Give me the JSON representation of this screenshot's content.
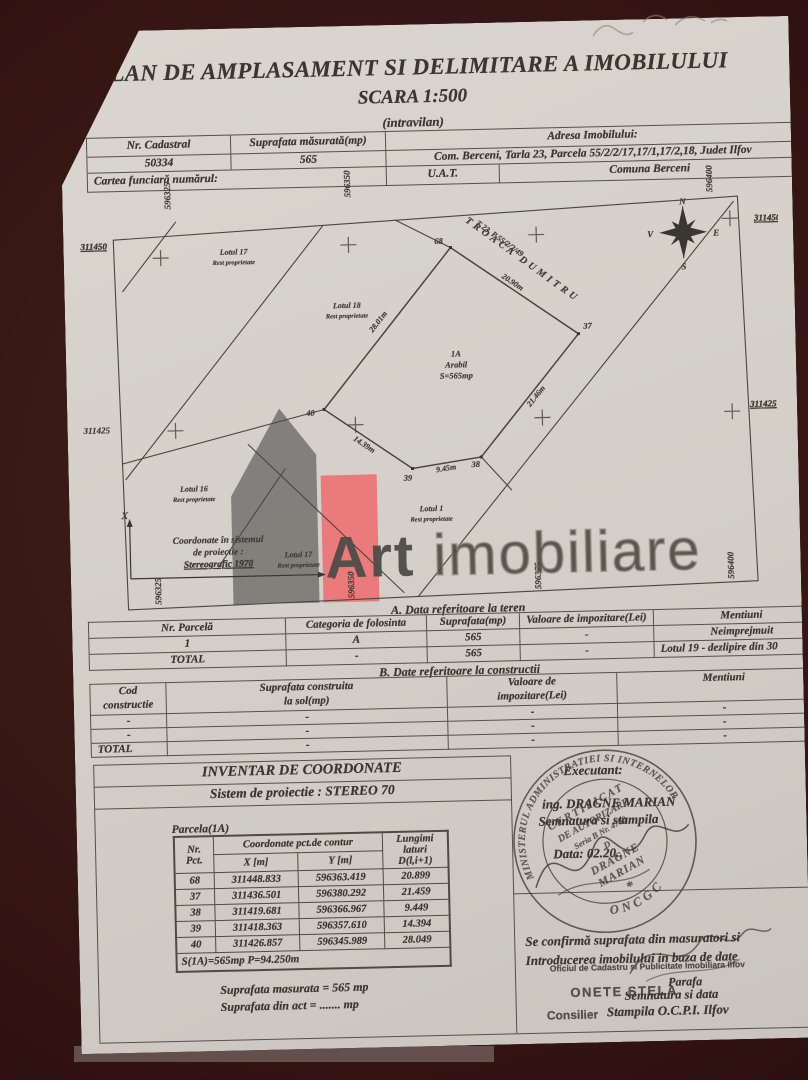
{
  "title": {
    "line1": "PLAN DE AMPLASAMENT SI DELIMITARE A IMOBILULUI",
    "line2": "SCARA 1:500",
    "line3": "(intravilan)"
  },
  "header_table": {
    "col1_label": "Nr. Cadastral",
    "col1_value": "50334",
    "col2_label": "Suprafata măsurată(mp)",
    "col2_value": "565",
    "col3_label": "Adresa Imobilului:",
    "col3_value": "Com. Berceni, Tarla 23, Parcela 55/2/2/17,17/1,17/2,18, Judet Ilfov",
    "row3_label": "Cartea funciară numărul:",
    "uat_label": "U.A.T.",
    "uat_value": "Comuna Berceni"
  },
  "map": {
    "grid": {
      "top": [
        "596325",
        "596350",
        "596400"
      ],
      "bottom": [
        "596325",
        "596350",
        "596375",
        "596400"
      ],
      "left": [
        "311450",
        "311425"
      ],
      "right": [
        "311450",
        "311425"
      ]
    },
    "neighbor_label": "T 23, P 55/2/2/49",
    "neighbor_name": "TROACA DUMITRU",
    "lots": [
      {
        "name": "Lotul 17",
        "sub": "Rest proprietate"
      },
      {
        "name": "Lotul 18",
        "sub": "Rest proprietate"
      },
      {
        "name": "Lotul 16",
        "sub": "Rest proprietate"
      },
      {
        "name": "Lotul 17",
        "sub": "Rest proprietate"
      },
      {
        "name": "Lotul 1",
        "sub": "Rest proprietate"
      }
    ],
    "parcel": {
      "line1": "1A",
      "line2": "Arabil",
      "line3": "S=565mp"
    },
    "lengths": [
      "28.01m",
      "20.90m",
      "21.46m",
      "9.45m",
      "14.39m"
    ],
    "points": [
      "68",
      "37",
      "38",
      "39",
      "40"
    ],
    "compass": {
      "n": "N",
      "e": "E",
      "s": "S",
      "w": "V"
    },
    "coord_note": {
      "line1": "Coordonate în sistemul",
      "line2": "de proiectie :",
      "line3": "Stereografic 1970",
      "x": "X",
      "y": "Y"
    },
    "watermark": {
      "bold": "Art",
      "light": " imobiliare"
    }
  },
  "section_a": {
    "title": "A. Data referitoare la teren",
    "headers": [
      "Nr. Parcelă",
      "Categoria de folosinta",
      "Suprafata(mp)",
      "Valoare de impozitare(Lei)",
      "Mentiuni"
    ],
    "rows": [
      [
        "1",
        "A",
        "565",
        "-",
        "Neimprejmuit"
      ],
      [
        "TOTAL",
        "-",
        "565",
        "-",
        "Lotul 19 - dezlipire din 30"
      ]
    ]
  },
  "section_b": {
    "title": "B. Date referitoare la constructii",
    "headers": [
      "Cod\nconstructie",
      "Suprafata construita\nla sol(mp)",
      "Valoare de\nimpozitare(Lei)",
      "Mentiuni"
    ],
    "rows": [
      [
        "-",
        "-",
        "-",
        "-"
      ],
      [
        "-",
        "-",
        "-",
        "-"
      ],
      [
        "TOTAL",
        "-",
        "-",
        "-"
      ]
    ]
  },
  "inventory": {
    "title": "INVENTAR DE COORDONATE",
    "subtitle": "Sistem de proiectie : STEREO 70",
    "parcel_label": "Parcela(1A)",
    "col_nr": "Nr.\nPct.",
    "col_group": "Coordonate pct.de contur",
    "col_x": "X [m]",
    "col_y": "Y [m]",
    "col_d": "Lungimi\nlaturi\nD(l,i+1)",
    "rows": [
      {
        "nr": "68",
        "x": "311448.833",
        "y": "596363.419",
        "d": "20.899"
      },
      {
        "nr": "37",
        "x": "311436.501",
        "y": "596380.292",
        "d": "21.459"
      },
      {
        "nr": "38",
        "x": "311419.681",
        "y": "596366.967",
        "d": "9.449"
      },
      {
        "nr": "39",
        "x": "311418.363",
        "y": "596357.610",
        "d": "14.394"
      },
      {
        "nr": "40",
        "x": "311426.857",
        "y": "596345.989",
        "d": "28.049"
      }
    ],
    "footer": "S(1A)=565mp  P=94.250m",
    "area_line1": "Suprafata masurata = 565 mp",
    "area_line2": "Suprafata din act = ....... mp"
  },
  "executant": {
    "label": "Executant:",
    "name": "ing. DRAGNE MARIAN",
    "line2": "Semnatura si stampila",
    "line3": "Data: 02.20.."
  },
  "round_stamp": {
    "outer_top": "MINISTERUL ADMINISTRATIEI SI INTERNELOR",
    "outer_bottom": "ONCGC",
    "inner1": "CERTIFICAT",
    "inner2": "DE AUTORIZARE",
    "inner3": "Seria B Nr. 4780",
    "inner4": "D",
    "inner5": "DRAGNE",
    "inner6": "MARIAN",
    "star": "*"
  },
  "confirmation": {
    "line1": "Se confirmă suprafata din masuratori si",
    "line2": "Introducerea imobilului in baza de date",
    "parafa": "Parafa",
    "line3": "Semnatura si data",
    "line4": "Stampila O.C.P.I. Ilfov"
  },
  "office_stamp": {
    "line1": "Oficiul de Cadastru si Publicitate Imobiliara Ilfov",
    "name": "ONETE STELA",
    "role": "Consilier"
  }
}
